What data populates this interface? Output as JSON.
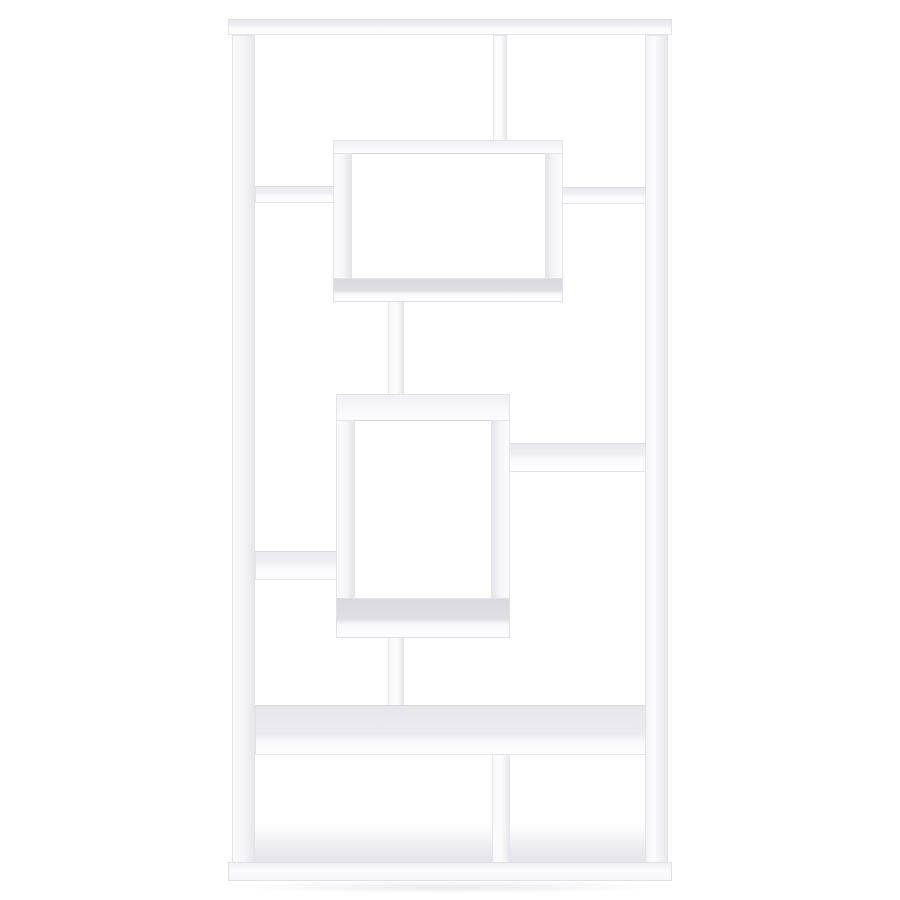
{
  "meta": {
    "description": "Studio product photograph of a tall white geometric bookcase (asymmetrical etagere with interlocking rectangular shelves) centered on a plain white background",
    "background_color": "#ffffff"
  },
  "product": {
    "name": "white-geometric-etagere-bookcase",
    "finish_color": "#fbfbfd",
    "shading_color": "#dcdce1",
    "edge_color": "#e3e3e8",
    "style": "asymmetrical interlocking open-back shelving with two protruding display boxes",
    "open_compartments": 10
  },
  "scene": {
    "canvas": {
      "width": 900,
      "height": 900
    },
    "parts": [
      {
        "name": "top-board",
        "variant": "board-h",
        "rect": [
          228,
          19,
          444,
          16
        ]
      },
      {
        "name": "left-side-panel",
        "variant": "panel-left",
        "rect": [
          232,
          35,
          23,
          828
        ]
      },
      {
        "name": "right-side-panel",
        "variant": "panel-right",
        "rect": [
          645,
          35,
          23,
          828
        ]
      },
      {
        "name": "top-section-divider",
        "variant": "post",
        "rect": [
          493,
          35,
          14,
          107
        ]
      },
      {
        "name": "upper-left-shelf",
        "variant": "board-h",
        "rect": [
          255,
          186,
          79,
          17
        ]
      },
      {
        "name": "upper-right-shelf",
        "variant": "board-h",
        "rect": [
          562,
          187,
          84,
          17
        ]
      },
      {
        "name": "upper-center-post",
        "variant": "post",
        "rect": [
          388,
          300,
          16,
          98
        ]
      },
      {
        "name": "middle-right-shelf",
        "variant": "board-h",
        "rect": [
          509,
          443,
          137,
          29
        ]
      },
      {
        "name": "lower-left-shelf",
        "variant": "board-h",
        "rect": [
          255,
          551,
          86,
          29
        ]
      },
      {
        "name": "lower-center-post",
        "variant": "post",
        "rect": [
          388,
          636,
          16,
          72
        ]
      },
      {
        "name": "wide-lower-shelf",
        "variant": "board-big",
        "rect": [
          255,
          705,
          391,
          50
        ]
      },
      {
        "name": "bottom-divider",
        "variant": "post",
        "rect": [
          492,
          754,
          18,
          109
        ]
      },
      {
        "name": "bottom-floor-left",
        "variant": "floor-hint",
        "rect": [
          255,
          824,
          237,
          38
        ]
      },
      {
        "name": "bottom-floor-right",
        "variant": "floor-hint",
        "rect": [
          510,
          824,
          135,
          38
        ]
      },
      {
        "name": "bottom-board",
        "variant": "board-bottom",
        "rect": [
          228,
          862,
          444,
          19
        ]
      },
      {
        "name": "top-box-top",
        "variant": "strip-top",
        "rect": [
          333,
          140,
          230,
          14
        ]
      },
      {
        "name": "top-box-left",
        "variant": "strip-left",
        "rect": [
          333,
          153,
          19,
          130
        ]
      },
      {
        "name": "top-box-right",
        "variant": "strip-right",
        "rect": [
          545,
          153,
          18,
          130
        ]
      },
      {
        "name": "top-box-bottom",
        "variant": "strip-bottom",
        "rect": [
          333,
          278,
          230,
          24
        ]
      },
      {
        "name": "middle-box-top",
        "variant": "strip-top",
        "rect": [
          336,
          394,
          174,
          27
        ]
      },
      {
        "name": "middle-box-left",
        "variant": "strip-left",
        "rect": [
          336,
          420,
          19,
          188
        ]
      },
      {
        "name": "middle-box-right",
        "variant": "strip-right",
        "rect": [
          491,
          420,
          19,
          188
        ]
      },
      {
        "name": "middle-box-bottom",
        "variant": "strip-bottom",
        "rect": [
          336,
          598,
          174,
          40
        ]
      },
      {
        "name": "ground-shadow",
        "variant": "ground-shadow",
        "rect": [
          236,
          880,
          428,
          14
        ]
      }
    ]
  }
}
